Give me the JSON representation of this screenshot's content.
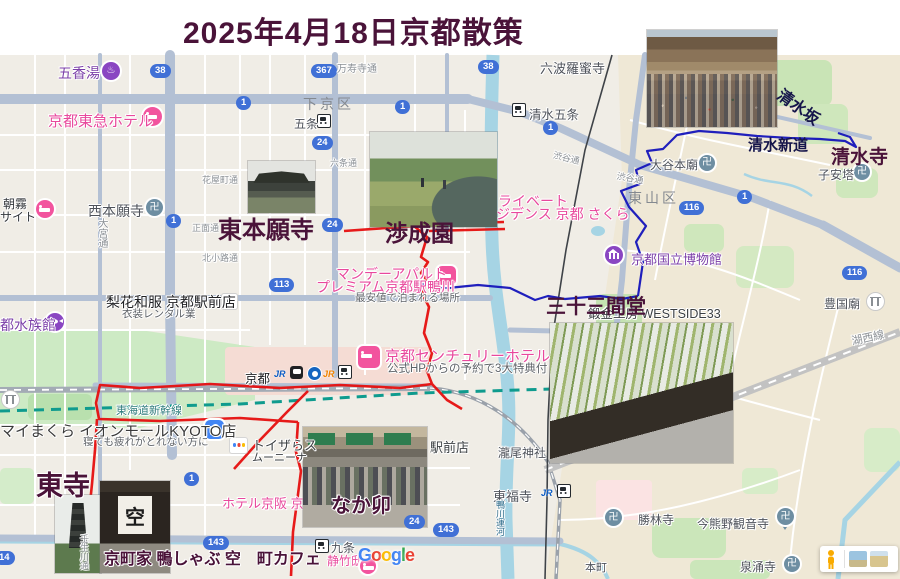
{
  "title": "2025年4月18日京都散策",
  "ann": {
    "higashihonganji": "東本願寺",
    "shoseien": "渉成園",
    "sanjusangendo": "三十三間堂",
    "kiyomizudera": "清水寺",
    "kiyomizushindo": "清水新道",
    "kiyomizuzaka": "清水坂",
    "toji": "東寺",
    "nakau": "なか卯",
    "caption": "京町家 鴨しゃぶ 空　町カフェ"
  },
  "area": {
    "shimogyoku": "下京区",
    "higashiyamaku": "東山区"
  },
  "poi": {
    "gokoyu": "五香湯",
    "nishihonganji": "西本願寺",
    "rokuharamitsuji": "六波羅蜜寺",
    "otanihombyo": "大谷本廟",
    "koyasunoto": "子安塔",
    "museum": "京都国立博物館",
    "toyokunibyo": "豊国廟",
    "shorinji": "勝林寺",
    "imakumano": "今熊野観音寺",
    "sennyuji": "泉涌寺",
    "takinoo": "瀧尾神社",
    "aquarium": "京都水族館",
    "westside": "鍛金工房 WESTSIDE33",
    "honmachi": "本町",
    "ekimaeten": "駅前店"
  },
  "sta": {
    "gojo": "五条",
    "kiyomizugojo": "清水五条",
    "kyoto": "京都",
    "kujo": "九条",
    "tofukuji": "東福寺",
    "jr": "JR"
  },
  "street": {
    "manjuji": "万寿寺通",
    "rokujo": "六条通",
    "shomen": "正面通",
    "kitakoji": "北小路通",
    "hanayacho": "花屋町通",
    "omiya": "大宮通",
    "mibu": "壬生川通",
    "shibuya1": "渋谷通",
    "shibuya2": "渋谷通",
    "kamogawaunga": "鴨川運河",
    "shinkansen": "東海道新幹線",
    "koseisen": "湖西線"
  },
  "ads": {
    "rika1": "梨花和服 京都駅前店",
    "rika2": "衣装レンタル業",
    "monday1": "マンデーアパルト",
    "monday2": "プレミアム京都駅鴨川",
    "monday3": "最安値で泊まれる場所",
    "tokyu": "京都東急ホテル",
    "asagiri1": "朝霧",
    "asagiri2": "サイト",
    "private1": "ライベート",
    "private2": "ジデンス 京都 さくら",
    "century1": "京都センチュリーホテル",
    "century2": "公式HPからの予約で3大特典付",
    "mymakura1": "マイまくら イオンモールKYOTO店",
    "mymakura2": "寝ても疲れがとれない方に",
    "toys1": "トイザらス",
    "toys2": "ムーニーナ",
    "keihanhotel": "ホテル京阪 京都八条口",
    "seichikutei": "静竹邸"
  },
  "shields": [
    "38",
    "367",
    "1",
    "38",
    "1",
    "24",
    "1",
    "24",
    "113",
    "1",
    "1",
    "116",
    "116",
    "1",
    "143",
    "24",
    "143",
    "14"
  ],
  "manji": "卍",
  "noren": "空",
  "logo": [
    "G",
    "o",
    "o",
    "g",
    "l",
    "e"
  ],
  "colors": {
    "route_red": "#e60f0f",
    "route_blue": "#1414bb",
    "annotation": "#4a1339",
    "water": "#a6d4e4",
    "shield": "#4070d6",
    "poi_purple": "#8a46c2",
    "ad_pink": "#e8489c"
  }
}
